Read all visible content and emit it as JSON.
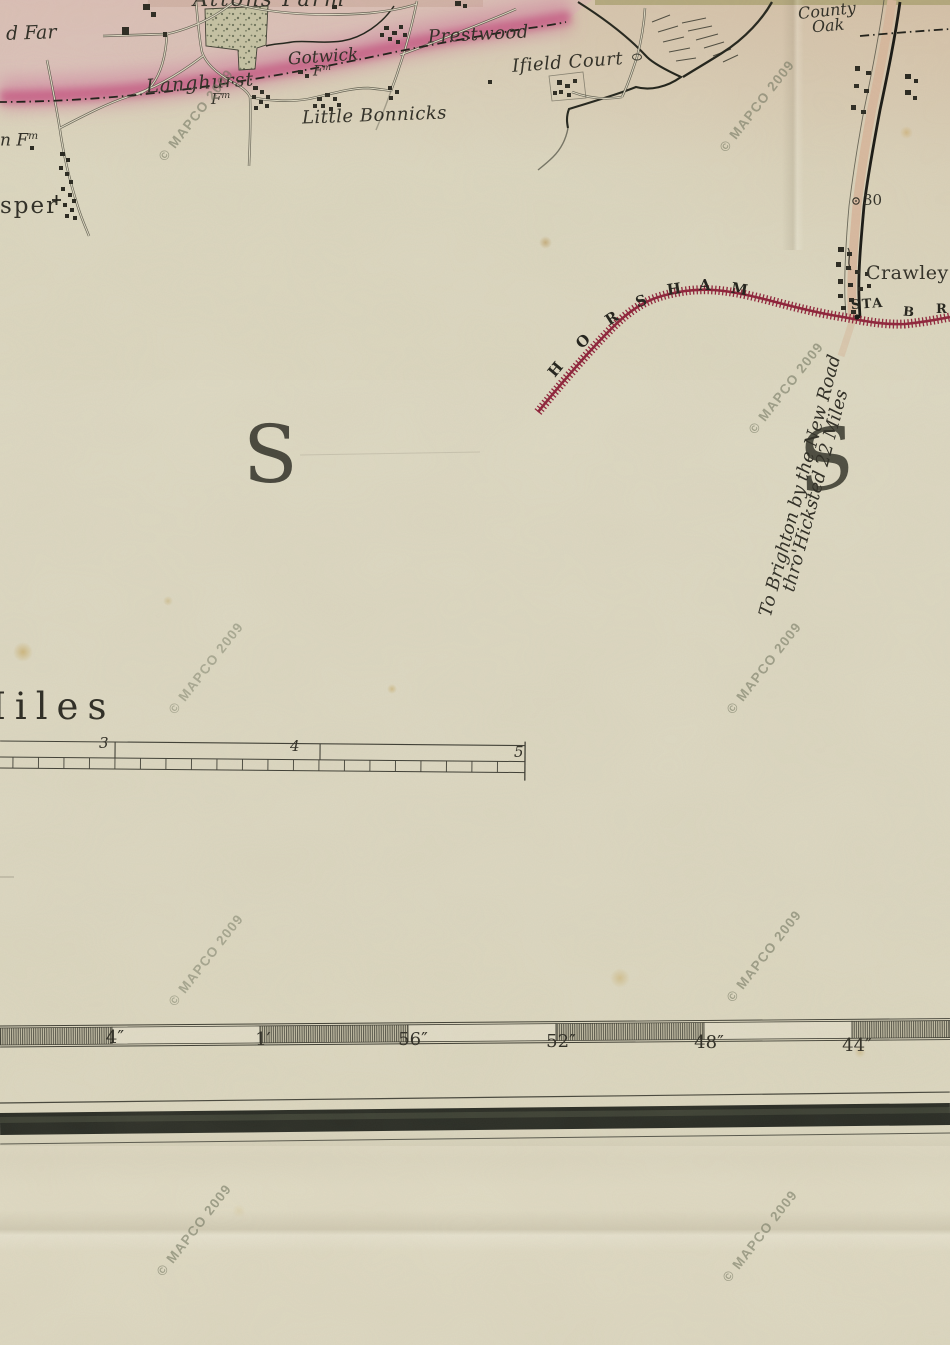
{
  "watermark": {
    "text": "© MAPCO 2009"
  },
  "colors": {
    "paper": "#ddd8c1",
    "ink": "#2b2a22",
    "railway": "#8e2038",
    "road_tint": "#d8b79c",
    "boundary_pink": "#cf6f97",
    "border_band": "#262922"
  },
  "map": {
    "places": {
      "attons_farm": "Attons Farm",
      "d_far": "d Far",
      "n_fm_prefix": "n",
      "fm": "F",
      "fm_sup": "m",
      "sper": "sper",
      "langhurst": "Langhurst",
      "gotwick": "Gotwick",
      "little_bonnicks": "Little Bonnicks",
      "prestwood": "Prestwood",
      "ifield_court": "Ifield Court",
      "county_oak_1": "County",
      "county_oak_2": "Oak",
      "crawley": "Crawley"
    },
    "railway": {
      "name_letters": [
        "H",
        "O",
        "R",
        "S",
        "H",
        "A",
        "M"
      ],
      "station": "STA",
      "branch_letters": [
        "B",
        "R"
      ]
    },
    "annotations": {
      "to_brighton_1": "To Brighton by the New Road",
      "to_brighton_2": "thro'Hicksted 22 Miles",
      "big_s_left": "S",
      "big_s_right": "S",
      "milestone": "30"
    },
    "scale_bar": {
      "label": "Miles",
      "numbers": [
        "3",
        "4",
        "5"
      ]
    },
    "ruler": {
      "labels": [
        "4″",
        "1′",
        "56″",
        "52″",
        "48″",
        "44″"
      ]
    }
  }
}
